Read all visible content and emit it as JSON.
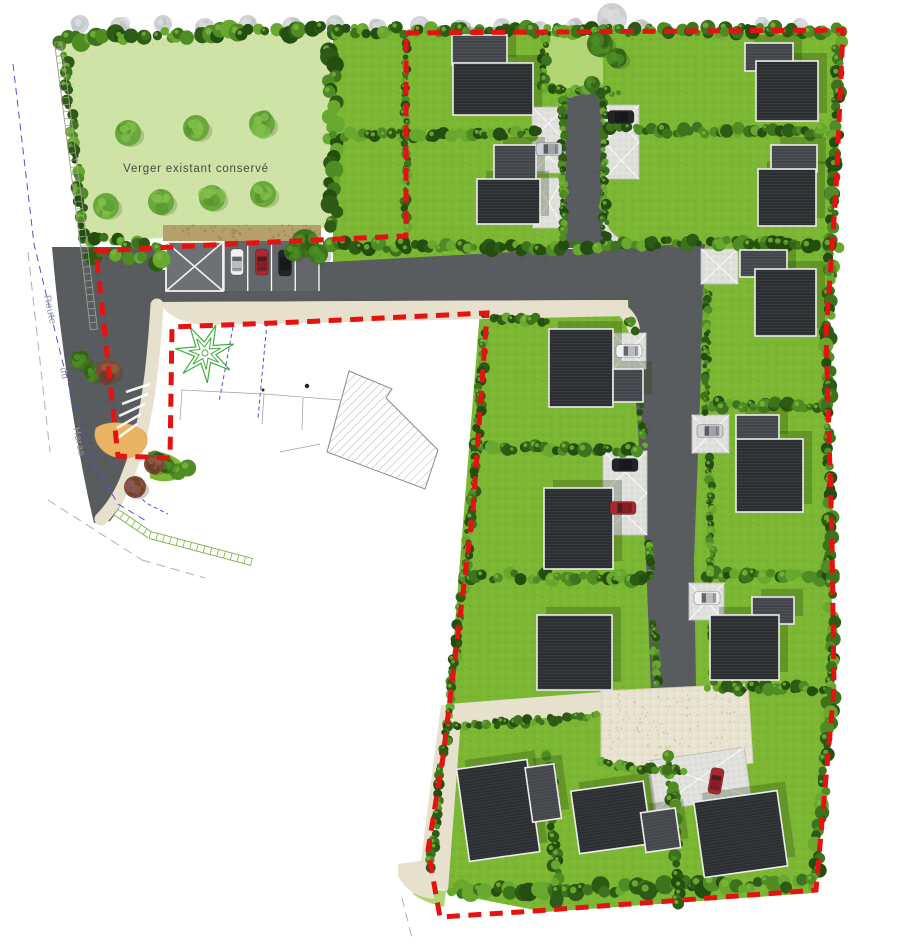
{
  "labels": {
    "orchard": "Verger existant conservé",
    "street_words": [
      "Route",
      "du",
      "Haras"
    ]
  },
  "colors": {
    "lawn": "#7cb733",
    "lawn_light": "#b2d573",
    "orchard": "#cfe3a6",
    "road": "#595c5f",
    "court": "#e8e2d0",
    "path_beige": "#e7e0cc",
    "driveway": "#e0e0dd",
    "gravel_tan": "#b3a06a",
    "island_amber": "#e9b564",
    "boundary_red": "#e61212",
    "roof_main": "#2c2f32",
    "roof_wing": "#43474b",
    "hedge_palette": [
      "#2d5a14",
      "#3d731c",
      "#4f8c24",
      "#68a82e",
      "#244e10"
    ],
    "hedge_highlight": "#79b83a",
    "tree_base": "#69a83a",
    "tree_blob": "#58962e",
    "tree_hi": "#82c04c",
    "gray_tree": "#c3c5c7",
    "blue_dash": "#5252cc",
    "star_green": "#3fae3f",
    "car": {
      "white": "#f0f1f2",
      "silver": "#ced2d5",
      "black": "#232527",
      "red": "#ab2830"
    }
  },
  "scene": {
    "hedges": [
      [
        62,
        39,
        330,
        30,
        10
      ],
      [
        64,
        48,
        85,
        240,
        7
      ],
      [
        332,
        32,
        333,
        226,
        10
      ],
      [
        84,
        237,
        158,
        246,
        8
      ],
      [
        90,
        255,
        160,
        262,
        10
      ],
      [
        325,
        246,
        600,
        248,
        8
      ],
      [
        336,
        136,
        540,
        133,
        7
      ],
      [
        406,
        40,
        406,
        226,
        5
      ],
      [
        336,
        31,
        840,
        30,
        8
      ],
      [
        563,
        98,
        563,
        238,
        5
      ],
      [
        604,
        98,
        604,
        208,
        5
      ],
      [
        607,
        130,
        836,
        132,
        8
      ],
      [
        605,
        243,
        700,
        243,
        7
      ],
      [
        605,
        198,
        605,
        241,
        6
      ],
      [
        712,
        242,
        836,
        245,
        8
      ],
      [
        706,
        404,
        828,
        407,
        8
      ],
      [
        708,
        574,
        830,
        577,
        8
      ],
      [
        710,
        687,
        832,
        689,
        7
      ],
      [
        839,
        34,
        828,
        330,
        8
      ],
      [
        828,
        336,
        832,
        686,
        8
      ],
      [
        831,
        692,
        815,
        886,
        8
      ],
      [
        450,
        892,
        810,
        883,
        10
      ],
      [
        484,
        335,
        472,
        512,
        6
      ],
      [
        471,
        517,
        444,
        755,
        6
      ],
      [
        441,
        762,
        431,
        870,
        6
      ],
      [
        487,
        318,
        544,
        321,
        7
      ],
      [
        477,
        447,
        638,
        450,
        8
      ],
      [
        462,
        576,
        646,
        578,
        8
      ],
      [
        629,
        320,
        635,
        331,
        5
      ],
      [
        636,
        372,
        644,
        446,
        5
      ],
      [
        648,
        542,
        652,
        578,
        5
      ],
      [
        654,
        622,
        657,
        685,
        5
      ],
      [
        707,
        290,
        706,
        412,
        5
      ],
      [
        710,
        458,
        712,
        578,
        5
      ],
      [
        713,
        622,
        714,
        684,
        5
      ],
      [
        549,
        754,
        558,
        902,
        7
      ],
      [
        670,
        758,
        679,
        906,
        7
      ],
      [
        452,
        727,
        598,
        716,
        6
      ],
      [
        602,
        764,
        686,
        772,
        6
      ],
      [
        544,
        38,
        544,
        88,
        6
      ],
      [
        546,
        90,
        616,
        92,
        6
      ],
      [
        152,
        458,
        184,
        471,
        9
      ]
    ],
    "houses": [
      {
        "rot": 0,
        "cx": 0,
        "cy": 0,
        "parts": [
          [
            452,
            35,
            55,
            30,
            "w"
          ],
          [
            453,
            63,
            80,
            52,
            "m"
          ]
        ]
      },
      {
        "rot": 0,
        "cx": 0,
        "cy": 0,
        "parts": [
          [
            494,
            145,
            42,
            36,
            "w"
          ],
          [
            477,
            179,
            63,
            45,
            "m"
          ]
        ]
      },
      {
        "rot": 0,
        "cx": 0,
        "cy": 0,
        "parts": [
          [
            745,
            43,
            48,
            28,
            "w"
          ],
          [
            756,
            61,
            62,
            60,
            "m"
          ]
        ]
      },
      {
        "rot": 0,
        "cx": 0,
        "cy": 0,
        "parts": [
          [
            771,
            145,
            46,
            27,
            "w"
          ],
          [
            758,
            169,
            58,
            57,
            "m"
          ]
        ]
      },
      {
        "rot": 0,
        "cx": 0,
        "cy": 0,
        "parts": [
          [
            740,
            250,
            47,
            27,
            "w"
          ],
          [
            755,
            269,
            61,
            67,
            "m"
          ]
        ]
      },
      {
        "rot": 0,
        "cx": 0,
        "cy": 0,
        "parts": [
          [
            549,
            329,
            64,
            78,
            "m"
          ],
          [
            613,
            369,
            30,
            33,
            "w"
          ]
        ]
      },
      {
        "rot": 0,
        "cx": 0,
        "cy": 0,
        "parts": [
          [
            544,
            488,
            69,
            81,
            "m"
          ]
        ]
      },
      {
        "rot": 0,
        "cx": 0,
        "cy": 0,
        "parts": [
          [
            537,
            615,
            75,
            75,
            "m"
          ]
        ]
      },
      {
        "rot": 0,
        "cx": 0,
        "cy": 0,
        "parts": [
          [
            736,
            415,
            43,
            27,
            "w"
          ],
          [
            736,
            439,
            67,
            73,
            "m"
          ]
        ]
      },
      {
        "rot": 0,
        "cx": 0,
        "cy": 0,
        "parts": [
          [
            752,
            597,
            42,
            27,
            "w"
          ],
          [
            710,
            615,
            69,
            65,
            "m"
          ]
        ]
      },
      {
        "rot": -8,
        "cx": 505,
        "cy": 812,
        "parts": [
          [
            463,
            763,
            71,
            93,
            "m"
          ],
          [
            531,
            771,
            29,
            55,
            "w"
          ]
        ]
      },
      {
        "rot": -8,
        "cx": 618,
        "cy": 818,
        "parts": [
          [
            575,
            785,
            73,
            63,
            "m"
          ],
          [
            641,
            816,
            35,
            40,
            "w"
          ]
        ]
      },
      {
        "rot": -8,
        "cx": 741,
        "cy": 836,
        "parts": [
          [
            699,
            796,
            84,
            76,
            "m"
          ]
        ]
      }
    ],
    "cars": [
      [
        237,
        262,
        90,
        "white"
      ],
      [
        262,
        262,
        90,
        "red"
      ],
      [
        285,
        263,
        90,
        "black"
      ],
      [
        549,
        149,
        0,
        "silver"
      ],
      [
        621,
        117,
        0,
        "black"
      ],
      [
        629,
        351,
        0,
        "white"
      ],
      [
        710,
        431,
        0,
        "silver"
      ],
      [
        625,
        465,
        0,
        "black"
      ],
      [
        623,
        508,
        0,
        "red"
      ],
      [
        707,
        598,
        0,
        "white"
      ],
      [
        716,
        781,
        100,
        "red"
      ]
    ],
    "driveways": [
      [
        532,
        107,
        33,
        66,
        0
      ],
      [
        533,
        178,
        31,
        50,
        0
      ],
      [
        604,
        105,
        35,
        74,
        0
      ],
      [
        701,
        249,
        37,
        35,
        0
      ],
      [
        613,
        333,
        33,
        36,
        0
      ],
      [
        692,
        415,
        37,
        38,
        0
      ],
      [
        603,
        451,
        44,
        84,
        0
      ],
      [
        689,
        583,
        35,
        37,
        0
      ],
      [
        650,
        754,
        98,
        50,
        -8
      ]
    ],
    "orchard_trees": [
      [
        128,
        133
      ],
      [
        196,
        128
      ],
      [
        262,
        124
      ],
      [
        106,
        206
      ],
      [
        161,
        202
      ],
      [
        212,
        198
      ],
      [
        263,
        194
      ]
    ],
    "gray_trees": [
      [
        80,
        24,
        9
      ],
      [
        120,
        27,
        10
      ],
      [
        163,
        24,
        9
      ],
      [
        205,
        28,
        10
      ],
      [
        248,
        24,
        9
      ],
      [
        292,
        27,
        10
      ],
      [
        335,
        24,
        9
      ],
      [
        378,
        28,
        9
      ],
      [
        420,
        26,
        10
      ],
      [
        462,
        29,
        9
      ],
      [
        502,
        27,
        9
      ],
      [
        540,
        29,
        8
      ],
      [
        575,
        26,
        8
      ],
      [
        612,
        18,
        15
      ],
      [
        641,
        28,
        9
      ],
      [
        762,
        24,
        7
      ],
      [
        800,
        26,
        8
      ]
    ],
    "shrubs_red": [
      [
        108,
        371,
        12
      ],
      [
        154,
        464,
        10
      ],
      [
        135,
        487,
        11
      ]
    ],
    "bushes_green": [
      [
        305,
        243,
        14
      ],
      [
        318,
        254,
        10
      ],
      [
        293,
        252,
        9
      ],
      [
        600,
        44,
        13
      ],
      [
        617,
        58,
        10
      ],
      [
        592,
        84,
        8
      ],
      [
        80,
        360,
        10
      ],
      [
        93,
        373,
        9
      ],
      [
        166,
        465,
        8
      ]
    ],
    "star": {
      "cx": 205,
      "cy": 353,
      "r_outer": 30,
      "r_inner": 11,
      "points": 7
    },
    "parking": {
      "bays": {
        "x": 224,
        "y": 240,
        "w": 95,
        "h": 51,
        "count": 4
      },
      "xbox": {
        "x": 166,
        "y": 242,
        "w": 57,
        "h": 49
      }
    },
    "gravel": {
      "x": 163,
      "y": 225,
      "w": 158,
      "h": 16
    },
    "court_dots": {
      "x": 606,
      "y": 694,
      "w": 138,
      "h": 62
    },
    "fences": [
      {
        "pts": [
          [
            58,
            42
          ],
          [
            84,
            246
          ],
          [
            94,
            330
          ]
        ],
        "color": "#9aa093"
      },
      {
        "pts": [
          [
            116,
            512
          ],
          [
            150,
            535
          ],
          [
            252,
            562
          ]
        ],
        "color": "#7bb24a"
      }
    ],
    "blue_lines": [
      {
        "d": "M13,64 L34,244 L62,360 L92,460 L118,504 L148,522",
        "dash": "7 5"
      },
      {
        "d": "M233,327 L219,402",
        "dash": "4 3"
      },
      {
        "d": "M267,323 L258,418",
        "dash": "4 3"
      },
      {
        "d": "M128,484 L146,503 L168,514",
        "dash": "4 3"
      }
    ],
    "gray_dashes": [
      {
        "d": "M28,252 L50,452"
      },
      {
        "d": "M48,500 L142,560"
      },
      {
        "d": "M142,560 L205,578"
      },
      {
        "d": "M402,898 L413,942"
      }
    ],
    "outlines": [
      {
        "d": "M180,420 L182,390 L264,394 L262,424"
      },
      {
        "d": "M264,394 L340,400"
      },
      {
        "d": "M280,452 L320,444"
      },
      {
        "d": "M302,430 L303,398"
      }
    ],
    "dots": [
      [
        307,
        386,
        2.2
      ],
      [
        263,
        390,
        1.5
      ]
    ],
    "chevrons": [
      [
        150,
        384,
        126,
        392
      ],
      [
        148,
        394,
        122,
        404
      ],
      [
        145,
        404,
        119,
        416
      ],
      [
        141,
        414,
        117,
        428
      ],
      [
        137,
        424,
        115,
        440
      ]
    ]
  }
}
